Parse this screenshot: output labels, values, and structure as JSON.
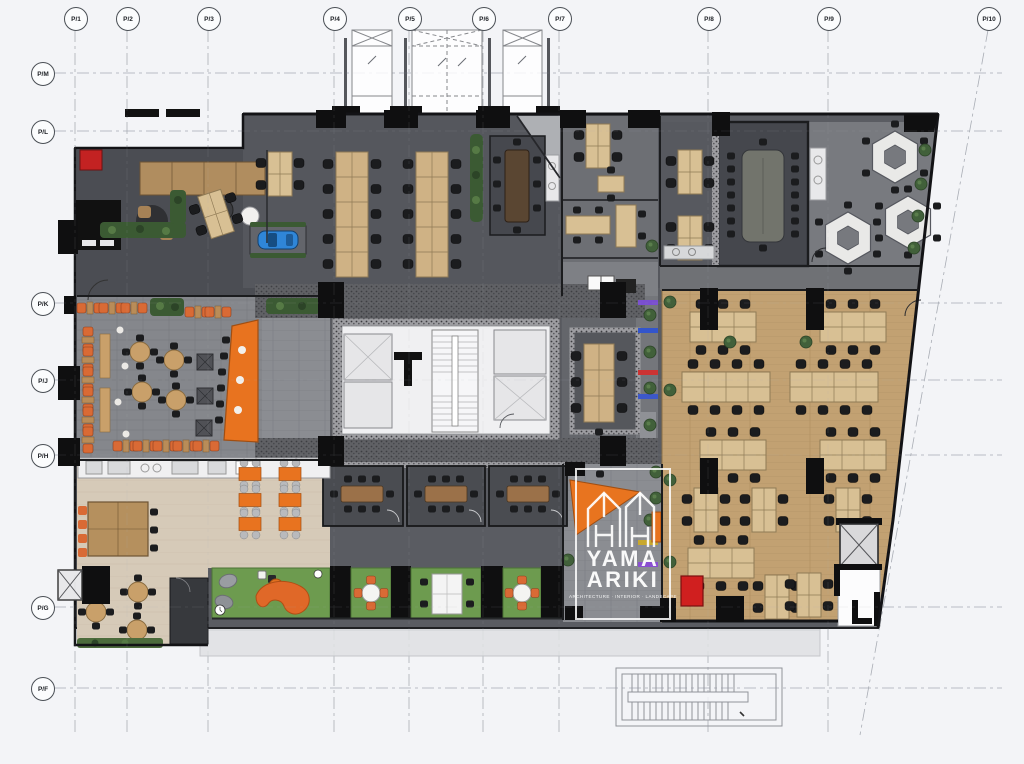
{
  "plan": {
    "name": "office-floor-plan"
  },
  "grid": {
    "bubble_y": 18,
    "bubble_x": 42,
    "columns": [
      {
        "label": "P/1",
        "x": 75
      },
      {
        "label": "P/2",
        "x": 127
      },
      {
        "label": "P/3",
        "x": 208
      },
      {
        "label": "P/4",
        "x": 334
      },
      {
        "label": "P/5",
        "x": 409
      },
      {
        "label": "P/6",
        "x": 483
      },
      {
        "label": "P/7",
        "x": 559
      },
      {
        "label": "P/8",
        "x": 708
      },
      {
        "label": "P/9",
        "x": 828
      },
      {
        "label": "P/10",
        "x": 988,
        "x_bottom": 860
      }
    ],
    "rows": [
      {
        "label": "P/M",
        "y": 73
      },
      {
        "label": "P/L",
        "y": 131
      },
      {
        "label": "P/K",
        "y": 303
      },
      {
        "label": "P/J",
        "y": 380
      },
      {
        "label": "P/H",
        "y": 455
      },
      {
        "label": "P/G",
        "y": 607
      },
      {
        "label": "P/F",
        "y": 688
      }
    ]
  },
  "watermark": {
    "line1": "YAMA",
    "line2": "ARIKI",
    "tagline": "ARCHITECTURE · INTERIOR · LANDSCAPE"
  },
  "colors": {
    "background": "#f3f4f7",
    "dark_floor": "#55575d",
    "paver_gray": "#85878c",
    "wood_floor": "#c2a172",
    "beige_floor": "#d6cab8",
    "turf_green": "#6d9b4f",
    "accent_orange": "#e8731f",
    "accent_red": "#d01f1f",
    "car_blue": "#2f86d8",
    "wall_black": "#131316",
    "core_white": "#f0f0f2"
  }
}
